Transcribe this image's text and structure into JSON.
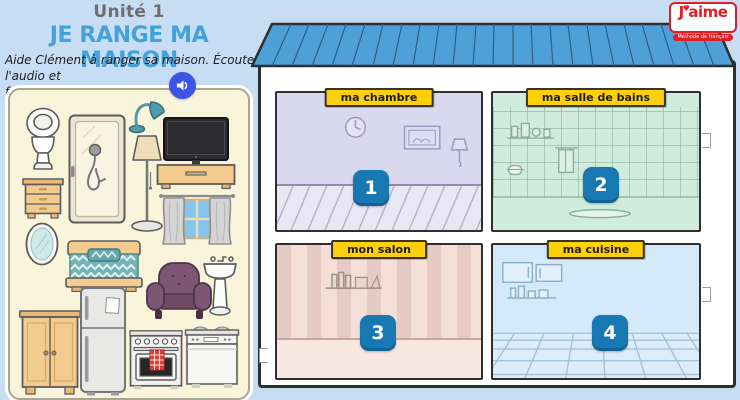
{
  "header": {
    "unit": "Unité 1",
    "title": "JE RANGE MA MAISON",
    "instruction_line1": "Aide Clément à ranger sa maison. Écoute l'audio et",
    "instruction_line2": "fais glisser chaque élément.",
    "audio_icon": "speaker-icon"
  },
  "logo": {
    "j": "J",
    "rest": "aime",
    "heart": "♥",
    "subtitle": "Méthode de français"
  },
  "rooms": [
    {
      "label": "ma chambre",
      "number": "1"
    },
    {
      "label": "ma salle de bains",
      "number": "2"
    },
    {
      "label": "mon salon",
      "number": "3"
    },
    {
      "label": "ma cuisine",
      "number": "4"
    }
  ],
  "furniture": {
    "items": [
      "toilet",
      "shower",
      "desk-lamp",
      "floor-lamp",
      "tv-stand",
      "dresser",
      "window-curtains",
      "mirror",
      "bed",
      "armchair",
      "pedestal-sink",
      "wardrobe",
      "fridge",
      "stove",
      "dishwasher"
    ]
  },
  "palette": {
    "background": "#c7ddf4",
    "title_blue": "#43a2da",
    "roof_blue": "#4fa0d9",
    "badge_blue": "#1778b2",
    "label_yellow": "#ffd008",
    "panel_cream": "#faf4da",
    "logo_red": "#dd1f26",
    "audio_blue": "#3d55e6",
    "room_chambre": "#d9d8ee",
    "room_salle_de_bains": "#cfecdd",
    "room_salon": "#f4ded8",
    "room_cuisine": "#d4e9f9"
  }
}
